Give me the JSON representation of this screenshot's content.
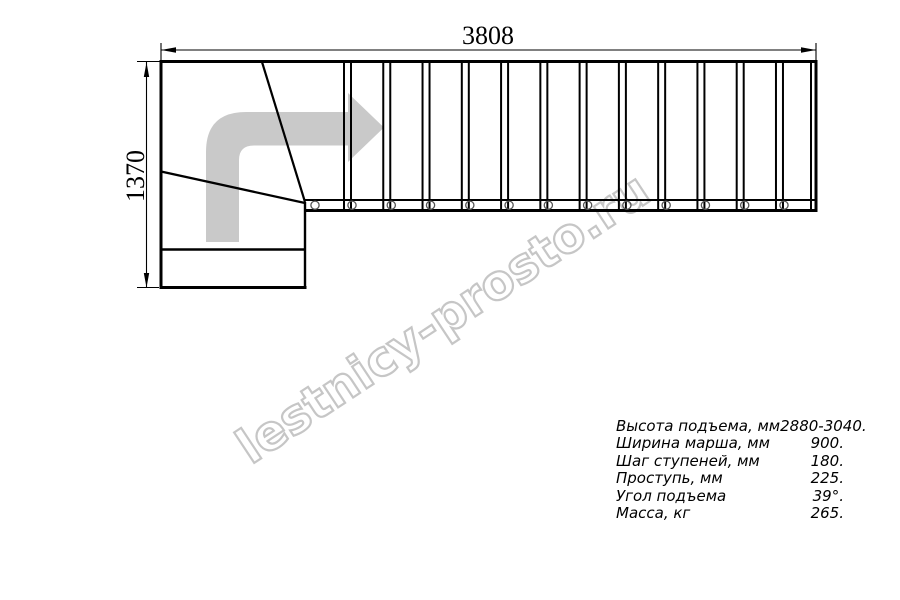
{
  "drawing": {
    "dimensions": {
      "width_label": "3808",
      "height_label": "1370"
    },
    "stairs": {
      "straight_tread_count": 13,
      "baluster_count": 13,
      "winder_tread_count": 3
    },
    "icons": {
      "direction_arrow": "curved-right-up-arrow"
    }
  },
  "watermark": {
    "text": "lestnicy-prosto.ru"
  },
  "specs": {
    "rows": [
      {
        "label": "Высота подъема, мм",
        "value": "2880-3040."
      },
      {
        "label": "Ширина марша, мм",
        "value": "900."
      },
      {
        "label": "Шаг ступеней, мм",
        "value": "180."
      },
      {
        "label": "Проступь, мм",
        "value": "225."
      },
      {
        "label": "Угол подъема",
        "value": "39°."
      },
      {
        "label": "Масса, кг",
        "value": "265."
      }
    ]
  },
  "colors": {
    "line": "#000000",
    "arrow_fill": "#c9c9c9",
    "watermark_outline": "#c6c6c6",
    "background": "#ffffff"
  }
}
